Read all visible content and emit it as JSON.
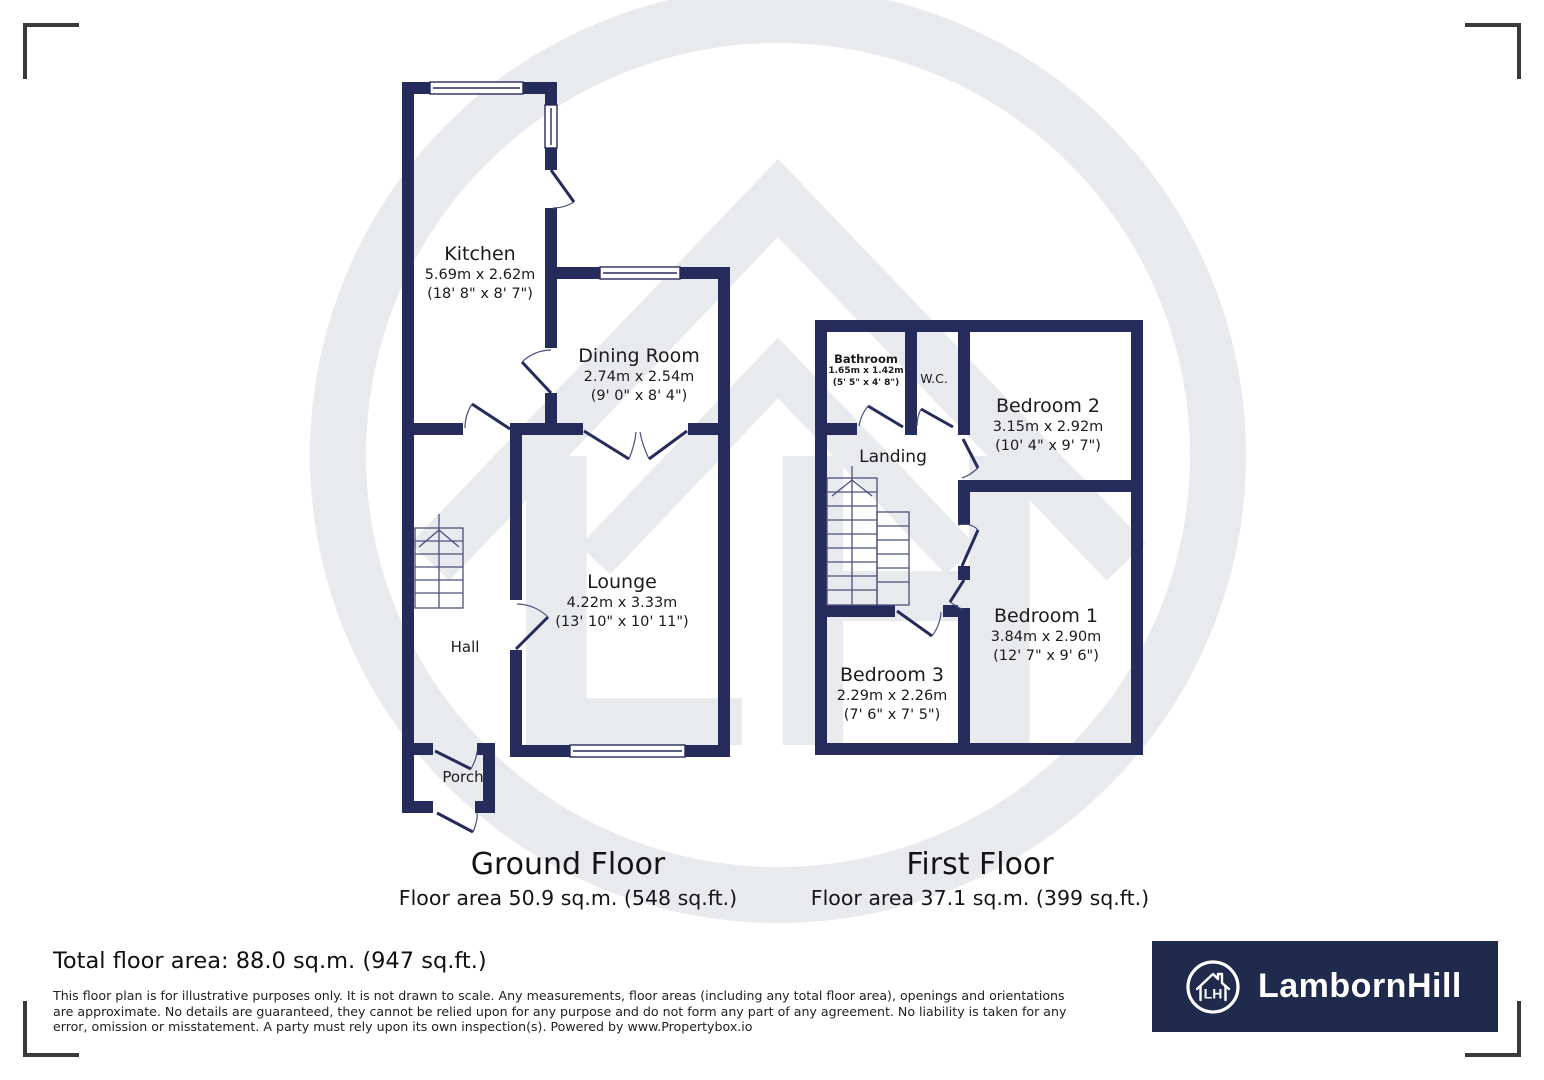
{
  "watermark": {
    "letters": "LH"
  },
  "ground_floor": {
    "title": "Ground Floor",
    "area": "Floor area 50.9 sq.m. (548 sq.ft.)",
    "rooms": {
      "kitchen": {
        "name": "Kitchen",
        "dims_m": "5.69m x 2.62m",
        "dims_ft": "(18' 8\" x 8' 7\")"
      },
      "dining": {
        "name": "Dining Room",
        "dims_m": "2.74m x 2.54m",
        "dims_ft": "(9' 0\" x 8' 4\")"
      },
      "lounge": {
        "name": "Lounge",
        "dims_m": "4.22m x 3.33m",
        "dims_ft": "(13' 10\" x 10' 11\")"
      },
      "hall": {
        "name": "Hall"
      },
      "porch": {
        "name": "Porch"
      }
    }
  },
  "first_floor": {
    "title": "First Floor",
    "area": "Floor area 37.1 sq.m. (399 sq.ft.)",
    "rooms": {
      "bathroom": {
        "name": "Bathroom",
        "dims_m": "1.65m x 1.42m",
        "dims_ft": "(5' 5\" x 4' 8\")"
      },
      "wc": {
        "name": "W.C."
      },
      "bedroom2": {
        "name": "Bedroom 2",
        "dims_m": "3.15m x 2.92m",
        "dims_ft": "(10' 4\" x 9' 7\")"
      },
      "landing": {
        "name": "Landing"
      },
      "bedroom1": {
        "name": "Bedroom 1",
        "dims_m": "3.84m x 2.90m",
        "dims_ft": "(12' 7\" x 9' 6\")"
      },
      "bedroom3": {
        "name": "Bedroom 3",
        "dims_m": "2.29m x 2.26m",
        "dims_ft": "(7' 6\" x 7' 5\")"
      }
    }
  },
  "footer": {
    "total_area": "Total floor area: 88.0 sq.m. (947 sq.ft.)",
    "disclaimer": "This floor plan is for illustrative purposes only. It is not drawn to scale. Any measurements, floor areas (including any total floor area), openings and orientations are approximate. No details are guaranteed, they cannot be relied upon for any purpose and do not form any part of any agreement. No liability is taken for any error, omission or misstatement. A party must rely upon its own inspection(s). Powered by www.Propertybox.io"
  },
  "brand": {
    "name": "LambornHill",
    "monogram": "LH"
  },
  "colors": {
    "wall": "#252b5b",
    "logo_bg": "#1f2a4c",
    "watermark": "#e9eaee",
    "bracket": "#3a3a3a"
  }
}
